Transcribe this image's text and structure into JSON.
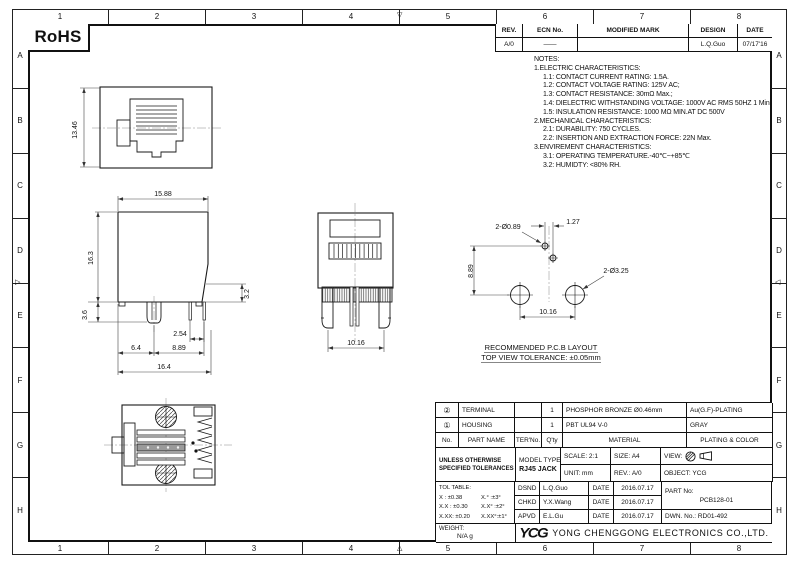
{
  "sheet": {
    "rohs_label": "RoHS",
    "grid_columns": [
      "1",
      "2",
      "3",
      "4",
      "5",
      "6",
      "7",
      "8"
    ],
    "grid_rows": [
      "A",
      "B",
      "C",
      "D",
      "E",
      "F",
      "G",
      "H"
    ]
  },
  "revision_table": {
    "headers": [
      "REV.",
      "ECN No.",
      "MODIFIED MARK",
      "DESIGN",
      "DATE"
    ],
    "row": {
      "rev": "A/0",
      "ecn": "——",
      "modified_mark": "",
      "design": "L.Q.Guo",
      "date": "07/17'16"
    }
  },
  "notes": {
    "title": "NOTES:",
    "lines": [
      "1.ELECTRIC CHARACTERISTICS:",
      "1.1: CONTACT CURRENT RATING: 1.5A.",
      "1.2: CONTACT VOLTAGE RATING: 125V AC;",
      "1.3: CONTACT RESISTANCE: 30mΩ Max.;",
      "1.4: DIELECTRIC WITHSTANDING VOLTAGE: 1000V AC RMS 50HZ 1 Min.",
      "1.5: INSULATION RESISTANCE: 1000 MΩ MIN.AT DC 500V",
      "2.MECHANICAL CHARACTERISTICS:",
      "2.1: DURABILITY: 750 CYCLES.",
      "2.2: INSERTION AND EXTRACTION FORCE: 22N Max.",
      "3.ENVIREMENT CHARACTERISTICS:",
      "3.1: OPERATING TEMPERATURE.-40℃~+85℃",
      "3.2: HUMIDTY: <80% RH."
    ]
  },
  "dimensions": {
    "front_height": "13.46",
    "side_top_width": "15.88",
    "side_height": "16.3",
    "side_pin_exposed": "3.2",
    "side_standoff": "3.6",
    "side_pin_pitch": "2.54",
    "side_leg_offset": "6.4",
    "side_pin_span": "8.89",
    "side_total_width": "16.4",
    "rear_leg_span": "10.16",
    "pcb_small_hole": "2-Ø0.89",
    "pcb_small_pitch": "1.27",
    "pcb_row_gap": "8.89",
    "pcb_big_hole": "2-Ø3.25",
    "pcb_big_pitch": "10.16",
    "pcb_caption_1": "RECOMMENDED P.C.B LAYOUT",
    "pcb_caption_2": "TOP VIEW TOLERANCE: ±0.05mm"
  },
  "parts_table": {
    "headers": {
      "no": "No.",
      "part_name": "PART NAME",
      "ter_no": "TER'No.",
      "qty": "Q'ty",
      "material": "MATERIAL",
      "plating": "PLATING & COLOR"
    },
    "rows": [
      {
        "no": "②",
        "part_name": "TERMINAL",
        "ter_no": "",
        "qty": "1",
        "material": "PHOSPHOR BRONZE Ø0.46mm",
        "plating": "Au(G.F)-PLATING"
      },
      {
        "no": "①",
        "part_name": "HOUSING",
        "ter_no": "",
        "qty": "1",
        "material": "PBT UL94 V-0",
        "plating": "GRAY"
      }
    ]
  },
  "title_block": {
    "tolerance_note_1": "UNLESS OTHERWISE",
    "tolerance_note_2": "SPECIFIED TOLERANCES",
    "scale": "SCALE: 2:1",
    "size": "SIZE:  A4",
    "view_label": "VIEW:",
    "unit": "UNIT:  mm",
    "rev": "REV.:  A/0",
    "object": "OBJECT:  YCG",
    "model_type_label": "MODEL TYPE:",
    "model_type_value": "RJ45 JACK",
    "tol_table_title": "TOL TABLE:",
    "tol_rows": [
      {
        "linear": "X  : ±0.38",
        "angular": "X.°  :±3°"
      },
      {
        "linear": "X.X : ±0.30",
        "angular": "X.X° :±2°"
      },
      {
        "linear": "X.XX: ±0.20",
        "angular": "X.XX°:±1°"
      }
    ],
    "signatures": [
      {
        "role": "DSND",
        "name": "L.Q.Guo",
        "date_label": "DATE",
        "date": "2016.07.17"
      },
      {
        "role": "CHKD",
        "name": "Y.X.Wang",
        "date_label": "DATE",
        "date": "2016.07.17"
      },
      {
        "role": "APVD",
        "name": "E.L.Gu",
        "date_label": "DATE",
        "date": "2016.07.17"
      }
    ],
    "part_no_label": "PART No:",
    "part_no_value": "PCB128-01",
    "dwn_no": "DWN. No.:  RD01-492",
    "weight_label": "WEIGHT:",
    "weight_value": "N/A  g",
    "company_logo": "YCG",
    "company_name": "YONG CHENGGONG ELECTRONICS CO.,LTD."
  }
}
